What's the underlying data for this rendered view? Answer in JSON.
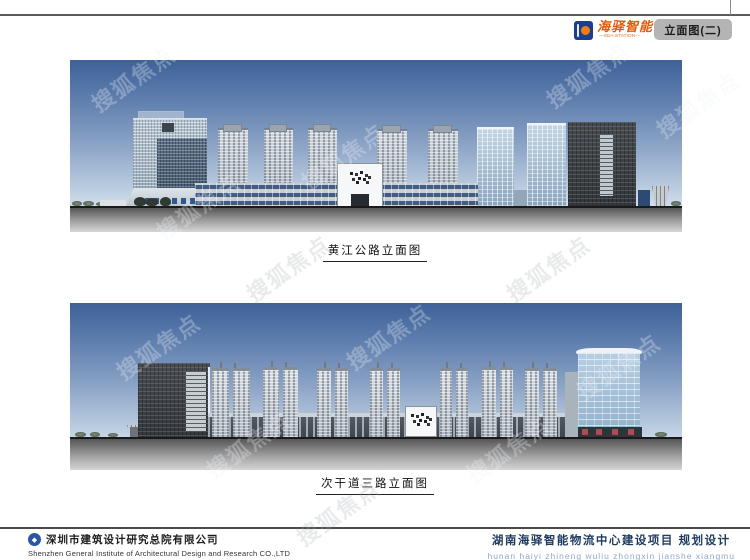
{
  "header": {
    "brand": {
      "name_cn": "海驿智能",
      "tagline": "—SEA-STATION—"
    },
    "sheet_title": "立面图(二)"
  },
  "watermark": {
    "text": "搜狐焦点"
  },
  "panels": [
    {
      "caption": "黄江公路立面图"
    },
    {
      "caption": "次干道三路立面图"
    }
  ],
  "footer": {
    "company_cn": "深圳市建筑设计研究总院有限公司",
    "company_en": "Shenzhen General Institute of Architectural Design and Research CO.,LTD",
    "project_cn": "湖南海驿智能物流中心建设项目 规划设计",
    "project_pinyin": "hunan haiyi zhineng wuliu zhongxin jianshe xiangmu"
  },
  "colors": {
    "brand_blue": "#1d3e8e",
    "brand_orange": "#e2590a",
    "title_box_gray": "#b4b4b4",
    "project_navy": "#1d3a5f",
    "pinyin_blue": "#8fa8cc",
    "sky_top": "#3e6198",
    "sky_bottom": "#f0f4f8"
  }
}
